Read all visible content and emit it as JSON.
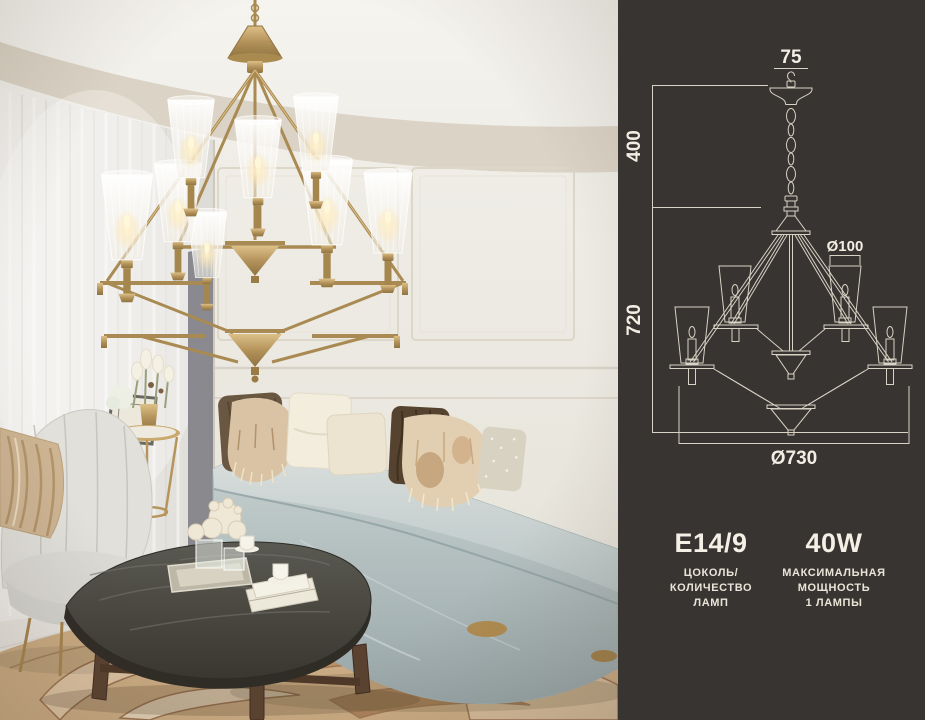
{
  "panel": {
    "background": "#373431",
    "line_color": "#d9d3c5",
    "text_color": "#f2eee3",
    "dimensions": {
      "hook_width": "75",
      "chain_drop": "400",
      "body_height": "720",
      "shade_diameter": "Ø100",
      "total_diameter": "Ø730"
    },
    "specs": [
      {
        "value": "E14/9",
        "label_lines": [
          "ЦОКОЛЬ/",
          "КОЛИЧЕСТВО",
          "ЛАМП"
        ]
      },
      {
        "value": "40W",
        "label_lines": [
          "МАКСИМАЛЬНАЯ",
          "МОЩНОСТЬ",
          "1 ЛАМПЫ"
        ]
      }
    ]
  },
  "photo": {
    "colors": {
      "brass": "#a98a52",
      "sofa_velvet": "#bcc8c8",
      "rug": "#cdad84",
      "ceiling": "#f2f0eb",
      "shade_glow": "#ffe9b8"
    }
  }
}
